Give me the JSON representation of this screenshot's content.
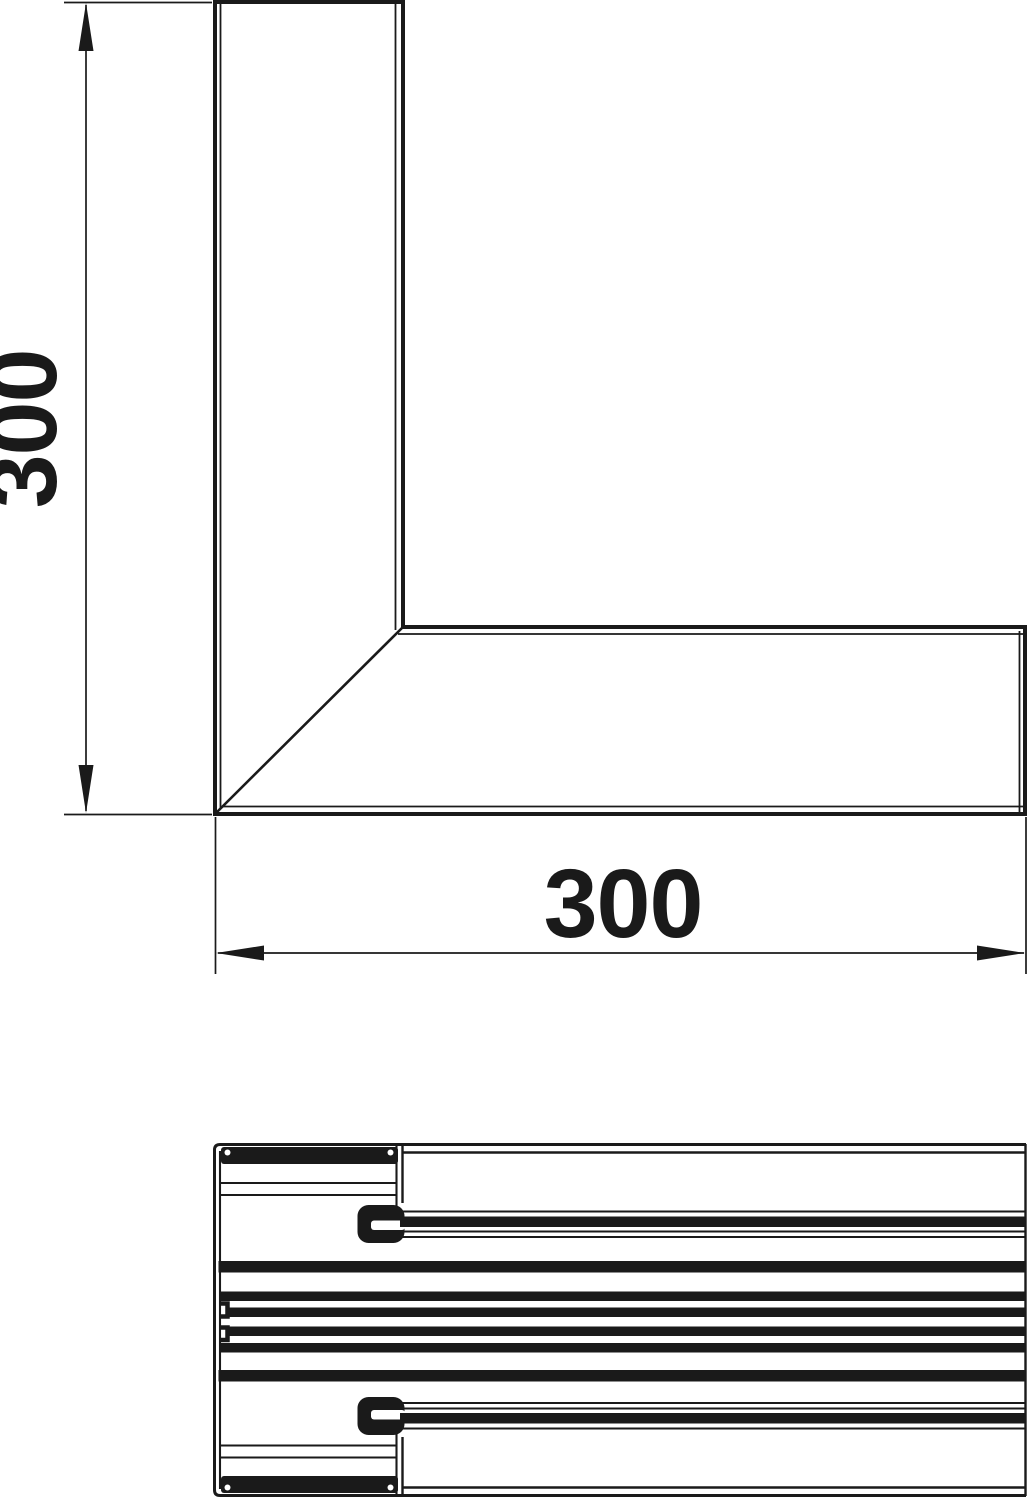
{
  "colors": {
    "line": "#1a1a1a",
    "background": "#ffffff"
  },
  "plan_view": {
    "vertical_dimension_label": "300",
    "horizontal_dimension_label": "300"
  }
}
